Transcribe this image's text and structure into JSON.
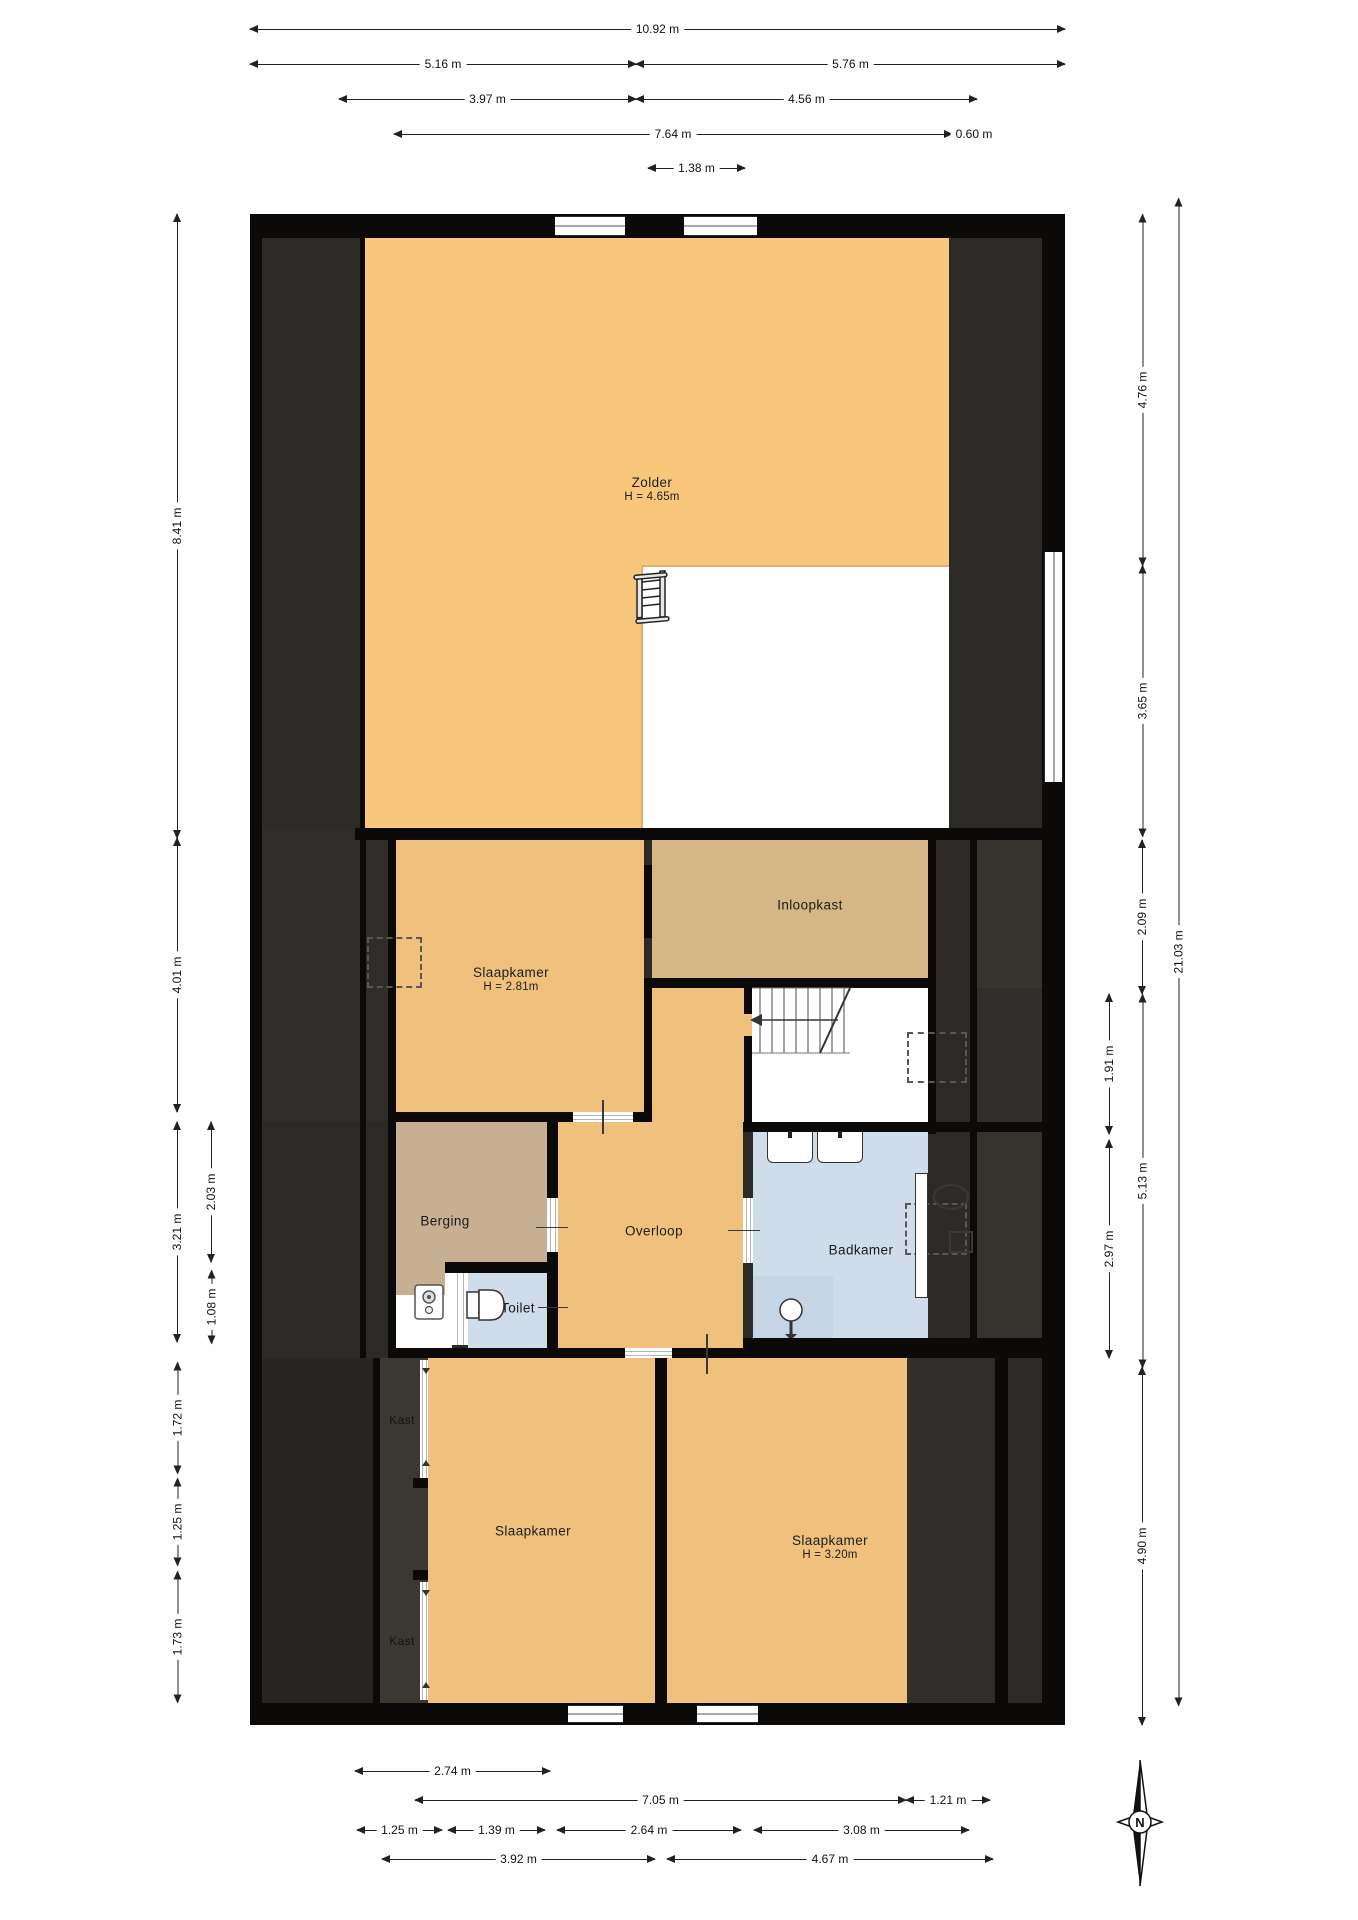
{
  "colors": {
    "wall": "#0b0a09",
    "dark_base": "#2b2a27",
    "attic_orange": "#f8c77c",
    "room_orange": "#f0c17d",
    "closet_tan": "#d6b586",
    "storage_tan": "#c7b092",
    "bath_blue": "#cfddeb",
    "shower_blue": "#c5d5e5",
    "void_white": "#ffffff"
  },
  "rooms": [
    {
      "id": "zolder",
      "color": "#f8c77c",
      "rects": [
        [
          365,
          238,
          584,
          590
        ]
      ],
      "label": {
        "text": "Zolder",
        "sub": "H = 4.65m",
        "x": 652,
        "y": 481
      }
    },
    {
      "id": "vide",
      "color": "#ffffff",
      "edge": true,
      "rects": [
        [
          641,
          565,
          308,
          263
        ]
      ],
      "label": null
    },
    {
      "id": "slaapkamer-1",
      "color": "#f0c17d",
      "rects": [
        [
          396,
          840,
          248,
          272
        ]
      ],
      "label": {
        "text": "Slaapkamer",
        "sub": "H = 2.81m",
        "x": 511,
        "y": 971
      }
    },
    {
      "id": "inloopkast",
      "color": "#d6b586",
      "rects": [
        [
          652,
          840,
          276,
          138
        ]
      ],
      "label": {
        "text": "Inloopkast",
        "x": 810,
        "y": 905
      }
    },
    {
      "id": "overloop",
      "color": "#f0c17d",
      "rects": [
        [
          652,
          988,
          92,
          134
        ],
        [
          558,
          1122,
          185,
          226
        ],
        [
          744,
          1014,
          8,
          22
        ]
      ],
      "label": {
        "text": "Overloop",
        "x": 654,
        "y": 1231
      }
    },
    {
      "id": "stairwell",
      "color": "#ffffff",
      "rects": [
        [
          752,
          988,
          176,
          134
        ]
      ],
      "label": null
    },
    {
      "id": "berging",
      "color": "#c7b092",
      "rects": [
        [
          396,
          1122,
          151,
          140
        ],
        [
          396,
          1262,
          49,
          33
        ]
      ],
      "label": {
        "text": "Berging",
        "x": 445,
        "y": 1221
      }
    },
    {
      "id": "niche",
      "color": "#ffffff",
      "rects": [
        [
          396,
          1295,
          49,
          53
        ],
        [
          445,
          1273,
          7,
          75
        ]
      ],
      "label": null
    },
    {
      "id": "toilet",
      "color": "#cfddeb",
      "rects": [
        [
          468,
          1273,
          79,
          75
        ]
      ],
      "label": {
        "text": "Toilet",
        "x": 518,
        "y": 1308
      }
    },
    {
      "id": "badkamer",
      "color": "#cfddeb",
      "rects": [
        [
          753,
          1132,
          175,
          206
        ]
      ],
      "label": {
        "text": "Badkamer",
        "x": 861,
        "y": 1250
      }
    },
    {
      "id": "shower",
      "color": "#c5d5e5",
      "rects": [
        [
          753,
          1276,
          80,
          62
        ]
      ],
      "label": null
    },
    {
      "id": "slaapkamer-2",
      "color": "#f0c17d",
      "rects": [
        [
          428,
          1358,
          227,
          345
        ]
      ],
      "label": {
        "text": "Slaapkamer",
        "x": 533,
        "y": 1531
      }
    },
    {
      "id": "slaapkamer-3",
      "color": "#f0c17d",
      "rects": [
        [
          667,
          1358,
          240,
          345
        ]
      ],
      "label": {
        "text": "Slaapkamer",
        "sub": "H = 3.20m",
        "x": 830,
        "y": 1539
      }
    }
  ],
  "free_labels": [
    {
      "id": "kast-1",
      "text": "Kast",
      "x": 402,
      "y": 1420,
      "color": "#15130f"
    },
    {
      "id": "kast-2",
      "text": "Kast",
      "x": 402,
      "y": 1641,
      "color": "#15130f"
    }
  ],
  "panels": [
    {
      "x": 262,
      "y": 238,
      "w": 780,
      "h": 1465,
      "c": "#2b2a27"
    },
    {
      "x": 262,
      "y": 828,
      "w": 126,
      "h": 294,
      "c": "#2f2d29"
    },
    {
      "x": 977,
      "y": 840,
      "w": 65,
      "h": 148,
      "c": "#37342f"
    },
    {
      "x": 977,
      "y": 988,
      "w": 65,
      "h": 144,
      "c": "#312f2b"
    },
    {
      "x": 977,
      "y": 1132,
      "w": 65,
      "h": 226,
      "c": "#36332f"
    },
    {
      "x": 936,
      "y": 1132,
      "w": 34,
      "h": 226,
      "c": "#2d2b28"
    },
    {
      "x": 907,
      "y": 1358,
      "w": 88,
      "h": 345,
      "c": "#302e2a"
    },
    {
      "x": 380,
      "y": 1358,
      "w": 48,
      "h": 345,
      "c": "#3b3831"
    },
    {
      "x": 262,
      "y": 1358,
      "w": 111,
      "h": 345,
      "c": "#262522"
    }
  ],
  "walls": [
    [
      250,
      214,
      815,
      24
    ],
    [
      250,
      214,
      12,
      1511
    ],
    [
      1042,
      214,
      23,
      1511
    ],
    [
      250,
      1703,
      815,
      22
    ],
    [
      355,
      828,
      687,
      12
    ],
    [
      388,
      840,
      8,
      508
    ],
    [
      644,
      865,
      8,
      73
    ],
    [
      644,
      978,
      8,
      134
    ],
    [
      644,
      978,
      292,
      10
    ],
    [
      928,
      840,
      8,
      148
    ],
    [
      928,
      988,
      8,
      146
    ],
    [
      743,
      1122,
      299,
      10
    ],
    [
      744,
      988,
      8,
      26
    ],
    [
      744,
      1036,
      8,
      86
    ],
    [
      388,
      1112,
      185,
      10
    ],
    [
      633,
      1112,
      19,
      10
    ],
    [
      547,
      1122,
      11,
      76
    ],
    [
      547,
      1252,
      11,
      96
    ],
    [
      445,
      1262,
      112,
      11
    ],
    [
      388,
      1348,
      237,
      10
    ],
    [
      672,
      1348,
      71,
      10
    ],
    [
      743,
      1338,
      299,
      20
    ],
    [
      655,
      1358,
      12,
      345
    ],
    [
      413,
      1478,
      15,
      10
    ],
    [
      413,
      1570,
      15,
      10
    ],
    [
      995,
      1358,
      13,
      345
    ],
    [
      360,
      238,
      6,
      1120
    ],
    [
      373,
      1358,
      7,
      345
    ],
    [
      970,
      840,
      7,
      518
    ]
  ],
  "windows": [
    {
      "o": "h",
      "x": 555,
      "y": 216,
      "w": 70,
      "h": 20
    },
    {
      "o": "h",
      "x": 684,
      "y": 216,
      "w": 73,
      "h": 20
    },
    {
      "o": "v",
      "x": 1044,
      "y": 552,
      "w": 19,
      "h": 230
    },
    {
      "o": "h",
      "x": 568,
      "y": 1705,
      "w": 55,
      "h": 18
    },
    {
      "o": "h",
      "x": 697,
      "y": 1705,
      "w": 61,
      "h": 18
    }
  ],
  "doors": [
    {
      "o": "h",
      "x": 573,
      "y": 1112,
      "w": 60,
      "h": 10
    },
    {
      "o": "v",
      "x": 547,
      "y": 1198,
      "w": 11,
      "h": 54
    },
    {
      "o": "v",
      "x": 743,
      "y": 1198,
      "w": 10,
      "h": 65
    },
    {
      "o": "h",
      "x": 625,
      "y": 1348,
      "w": 47,
      "h": 10
    },
    {
      "o": "v",
      "x": 452,
      "y": 1273,
      "w": 16,
      "h": 72
    },
    {
      "o": "v",
      "x": 420,
      "y": 1360,
      "w": 8,
      "h": 118
    },
    {
      "o": "v",
      "x": 420,
      "y": 1582,
      "w": 8,
      "h": 118
    }
  ],
  "dashed_boxes": [
    {
      "x": 367,
      "y": 937,
      "w": 55,
      "h": 51
    },
    {
      "x": 907,
      "y": 1032,
      "w": 60,
      "h": 51
    },
    {
      "x": 905,
      "y": 1203,
      "w": 62,
      "h": 52
    }
  ],
  "thin_lines": [
    {
      "x": 602,
      "y": 1100,
      "w": 2,
      "h": 34
    },
    {
      "x": 706,
      "y": 1334,
      "w": 2,
      "h": 40
    },
    {
      "x": 536,
      "y": 1227,
      "w": 32,
      "h": 1
    },
    {
      "x": 728,
      "y": 1230,
      "w": 32,
      "h": 1
    },
    {
      "x": 538,
      "y": 1307,
      "w": 30,
      "h": 1
    }
  ],
  "dimensions": [
    {
      "id": "top-total",
      "t": "10.92 m",
      "o": "h",
      "x1": 250,
      "x2": 1065,
      "y": 30
    },
    {
      "id": "top-left",
      "t": "5.16 m",
      "o": "h",
      "x1": 250,
      "x2": 636,
      "y": 65
    },
    {
      "id": "top-right",
      "t": "5.76 m",
      "o": "h",
      "x1": 636,
      "x2": 1065,
      "y": 65
    },
    {
      "id": "top-a",
      "t": "3.97 m",
      "o": "h",
      "x1": 339,
      "x2": 636,
      "y": 100
    },
    {
      "id": "top-b",
      "t": "4.56 m",
      "o": "h",
      "x1": 636,
      "x2": 977,
      "y": 100
    },
    {
      "id": "top-c",
      "t": "7.64 m",
      "o": "h",
      "x1": 394,
      "x2": 952,
      "y": 135
    },
    {
      "id": "top-d",
      "t": "0.60 m",
      "o": "h",
      "x1": 952,
      "x2": 996,
      "y": 135
    },
    {
      "id": "top-e",
      "t": "1.38 m",
      "o": "h",
      "x1": 648,
      "x2": 745,
      "y": 169
    },
    {
      "id": "bot-1",
      "t": "2.74 m",
      "o": "h",
      "x1": 355,
      "x2": 550,
      "y": 1772
    },
    {
      "id": "bot-2a",
      "t": "7.05 m",
      "o": "h",
      "x1": 415,
      "x2": 906,
      "y": 1801
    },
    {
      "id": "bot-2b",
      "t": "1.21 m",
      "o": "h",
      "x1": 906,
      "x2": 990,
      "y": 1801
    },
    {
      "id": "bot-3a",
      "t": "1.25 m",
      "o": "h",
      "x1": 357,
      "x2": 442,
      "y": 1831
    },
    {
      "id": "bot-3b",
      "t": "1.39 m",
      "o": "h",
      "x1": 448,
      "x2": 545,
      "y": 1831
    },
    {
      "id": "bot-3c",
      "t": "2.64 m",
      "o": "h",
      "x1": 557,
      "x2": 741,
      "y": 1831
    },
    {
      "id": "bot-3d",
      "t": "3.08 m",
      "o": "h",
      "x1": 754,
      "x2": 969,
      "y": 1831
    },
    {
      "id": "bot-4a",
      "t": "3.92 m",
      "o": "h",
      "x1": 382,
      "x2": 655,
      "y": 1860
    },
    {
      "id": "bot-4b",
      "t": "4.67 m",
      "o": "h",
      "x1": 667,
      "x2": 993,
      "y": 1860
    },
    {
      "id": "left-1",
      "t": "8.41 m",
      "o": "v",
      "y1": 214,
      "y2": 838,
      "x": 178
    },
    {
      "id": "left-2",
      "t": "4.01 m",
      "o": "v",
      "y1": 838,
      "y2": 1112,
      "x": 178
    },
    {
      "id": "left-3",
      "t": "3.21 m",
      "o": "v",
      "y1": 1122,
      "y2": 1342,
      "x": 178
    },
    {
      "id": "left-4",
      "t": "1.72 m",
      "o": "v",
      "y1": 1362,
      "y2": 1473,
      "x": 178
    },
    {
      "id": "left-5",
      "t": "1.25 m",
      "o": "v",
      "y1": 1478,
      "y2": 1565,
      "x": 178
    },
    {
      "id": "left-6",
      "t": "1.73 m",
      "o": "v",
      "y1": 1571,
      "y2": 1702,
      "x": 178
    },
    {
      "id": "left-in-1",
      "t": "2.03 m",
      "o": "v",
      "y1": 1122,
      "y2": 1262,
      "x": 212
    },
    {
      "id": "left-in-2",
      "t": "1.08 m",
      "o": "v",
      "y1": 1270,
      "y2": 1343,
      "x": 212
    },
    {
      "id": "right-1",
      "t": "4.76 m",
      "o": "v",
      "y1": 214,
      "y2": 565,
      "x": 1143
    },
    {
      "id": "right-2",
      "t": "3.65 m",
      "o": "v",
      "y1": 565,
      "y2": 836,
      "x": 1143
    },
    {
      "id": "right-3",
      "t": "2.09 m",
      "o": "v",
      "y1": 840,
      "y2": 994,
      "x": 1143
    },
    {
      "id": "right-4",
      "t": "1.91 m",
      "o": "v",
      "y1": 994,
      "y2": 1134,
      "x": 1110
    },
    {
      "id": "right-5",
      "t": "5.13 m",
      "o": "v",
      "y1": 994,
      "y2": 1367,
      "x": 1143
    },
    {
      "id": "right-6",
      "t": "2.97 m",
      "o": "v",
      "y1": 1140,
      "y2": 1358,
      "x": 1110
    },
    {
      "id": "right-7",
      "t": "4.90 m",
      "o": "v",
      "y1": 1367,
      "y2": 1725,
      "x": 1143
    },
    {
      "id": "right-total",
      "t": "21.03 m",
      "o": "v",
      "y1": 198,
      "y2": 1705,
      "x": 1179
    }
  ],
  "compass": {
    "label": "N",
    "cx": 1140,
    "cy": 1822
  }
}
